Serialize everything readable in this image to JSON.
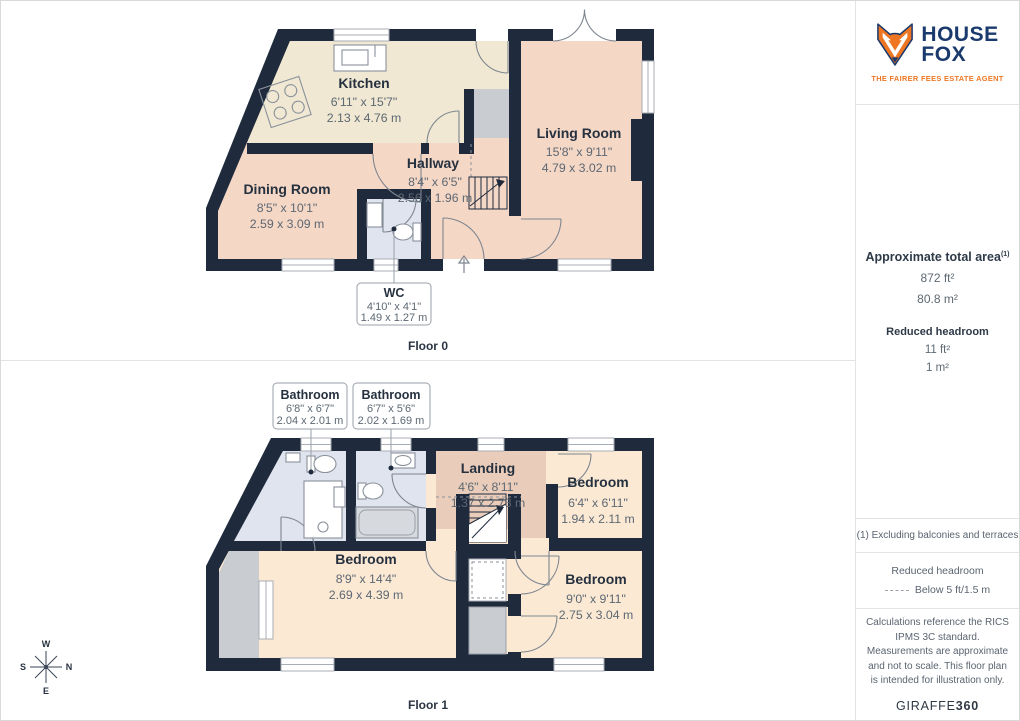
{
  "colors": {
    "wall": "#1F2B3D",
    "kitchen_floor": "#F0E8D2",
    "lounge_floor": "#F5D7C6",
    "bedroom_floor": "#FBE9D4",
    "landing_floor": "#E9CDBA",
    "bathroom_floor": "#DFE4EF",
    "void_gray": "#C9CCD1",
    "brand_navy": "#1A3A6D",
    "brand_orange": "#EE7623"
  },
  "panels": {
    "floor0": {
      "label": "Floor 0",
      "rooms": {
        "kitchen": {
          "name": "Kitchen",
          "imperial": "6'11\" x 15'7\"",
          "metric": "2.13 x 4.76 m"
        },
        "living_room": {
          "name": "Living Room",
          "imperial": "15'8\" x 9'11\"",
          "metric": "4.79 x 3.02 m"
        },
        "hallway": {
          "name": "Hallway",
          "imperial": "8'4\" x 6'5\"",
          "metric": "2.56 x 1.96 m"
        },
        "dining_room": {
          "name": "Dining Room",
          "imperial": "8'5\" x 10'1\"",
          "metric": "2.59 x 3.09 m"
        },
        "wc": {
          "name": "WC",
          "imperial": "4'10\" x 4'1\"",
          "metric": "1.49 x 1.27 m"
        }
      }
    },
    "floor1": {
      "label": "Floor 1",
      "rooms": {
        "bathroom_1": {
          "name": "Bathroom",
          "imperial": "6'8\" x 6'7\"",
          "metric": "2.04 x 2.01 m"
        },
        "bathroom_2": {
          "name": "Bathroom",
          "imperial": "6'7\" x 5'6\"",
          "metric": "2.02 x 1.69 m"
        },
        "landing": {
          "name": "Landing",
          "imperial": "4'6\" x 8'11\"",
          "metric": "1.37 x 2.73 m"
        },
        "bedroom_small": {
          "name": "Bedroom",
          "imperial": "6'4\" x 6'11\"",
          "metric": "1.94 x 2.11 m"
        },
        "bedroom_large": {
          "name": "Bedroom",
          "imperial": "8'9\" x 14'4\"",
          "metric": "2.69 x 4.39 m"
        },
        "bedroom_right": {
          "name": "Bedroom",
          "imperial": "9'0\" x 9'11\"",
          "metric": "2.75 x 3.04 m"
        }
      },
      "compass": {
        "top": "W",
        "left": "S",
        "right": "N",
        "bottom": "E"
      }
    }
  },
  "sidebar": {
    "logo": {
      "line1": "HOUSE",
      "line2": "FOX",
      "tagline": "THE FAIRER FEES ESTATE AGENT"
    },
    "area": {
      "title": "Approximate total area",
      "footnote_marker": "(1)",
      "imperial": "872 ft²",
      "metric": "80.8 m²",
      "reduced_title": "Reduced headroom",
      "reduced_imperial": "11 ft²",
      "reduced_metric": "1 m²"
    },
    "footnote": "(1) Excluding balconies and terraces",
    "legend": {
      "title": "Reduced headroom",
      "item": "Below 5 ft/1.5 m"
    },
    "disclaimer": "Calculations reference the RICS IPMS 3C standard. Measurements are approximate and not to scale. This floor plan is intended for illustration only.",
    "brand": {
      "name": "GIRAFFE",
      "suffix": "360"
    }
  }
}
